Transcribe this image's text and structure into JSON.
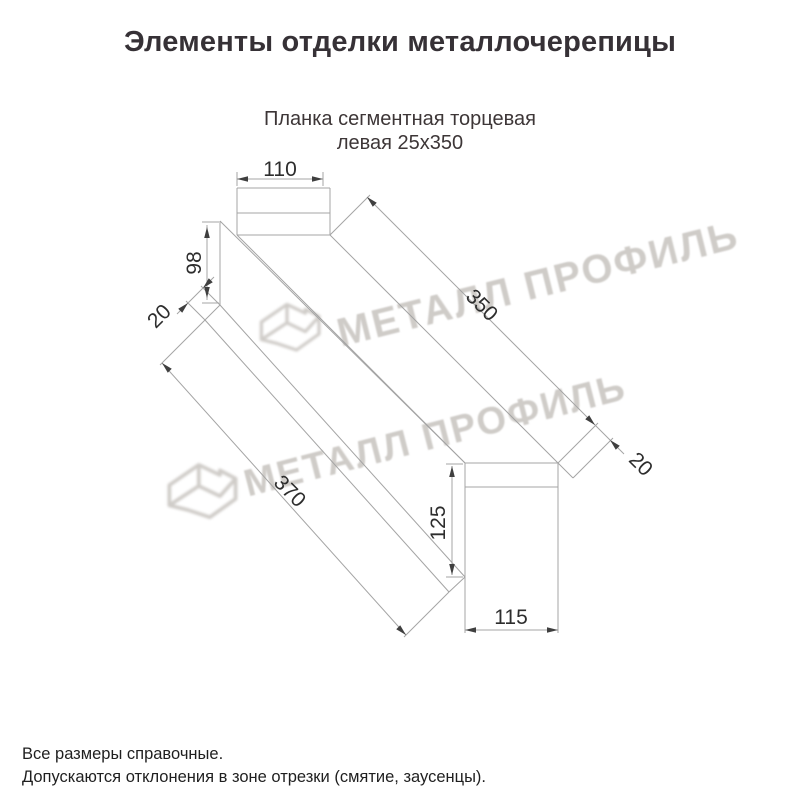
{
  "title": "Элементы отделки металлочерепицы",
  "subtitle_line1": "Планка сегментная торцевая",
  "subtitle_line2": "левая 25х350",
  "watermark": {
    "text": "МЕТАЛЛ ПРОФИЛЬ"
  },
  "notes": [
    "Все размеры справочные.",
    "Допускаются отклонения в зоне отрезки (смятие, заусенцы)."
  ],
  "colors": {
    "title": "#363136",
    "subtitle": "#3d3637",
    "line": "#a4a4a4",
    "arrow": "#3f3f3f",
    "dim_text": "#2d2d2d",
    "note_text": "#1f1f1f",
    "watermark": "#a8a29b"
  },
  "drawing": {
    "dimensions_mm": [
      110,
      98,
      20,
      350,
      20,
      370,
      125,
      115
    ],
    "lines": [
      [
        237,
        188,
        330,
        188
      ],
      [
        237,
        188,
        237,
        235
      ],
      [
        330,
        188,
        330,
        235
      ],
      [
        237,
        213,
        330,
        213
      ],
      [
        237,
        235,
        330,
        235
      ],
      [
        220,
        221,
        220,
        305
      ],
      [
        220,
        221,
        465,
        463
      ],
      [
        237,
        235,
        465,
        463
      ],
      [
        330,
        235,
        558,
        463
      ],
      [
        220,
        305,
        465,
        577
      ],
      [
        205,
        320,
        449,
        592
      ],
      [
        220,
        305,
        205,
        320
      ],
      [
        449,
        592,
        465,
        577
      ],
      [
        558,
        463,
        573,
        478
      ],
      [
        465,
        463,
        558,
        463
      ],
      [
        465,
        487,
        558,
        487
      ],
      [
        465,
        463,
        465,
        633
      ],
      [
        558,
        463,
        558,
        633
      ],
      [
        237,
        186,
        237,
        172
      ],
      [
        323,
        186,
        323,
        172
      ],
      [
        237,
        179,
        323,
        179
      ],
      [
        202,
        222,
        219,
        222
      ],
      [
        202,
        303,
        219,
        303
      ],
      [
        207,
        225,
        207,
        300
      ],
      [
        220,
        305,
        201,
        286
      ],
      [
        205,
        320,
        186,
        301
      ],
      [
        214,
        277,
        177,
        314
      ],
      [
        330,
        235,
        370,
        195
      ],
      [
        558,
        463,
        598,
        423
      ],
      [
        573,
        478,
        613,
        438
      ],
      [
        367,
        197,
        595,
        425
      ],
      [
        595,
        425,
        624,
        454
      ],
      [
        205,
        320,
        160,
        365
      ],
      [
        449,
        592,
        404,
        637
      ],
      [
        162,
        363,
        406,
        635
      ],
      [
        446,
        464,
        463,
        464
      ],
      [
        446,
        577,
        463,
        577
      ],
      [
        452,
        466,
        452,
        575
      ],
      [
        465,
        630,
        558,
        630
      ]
    ],
    "arrows": [
      [
        237,
        179,
        180
      ],
      [
        323,
        179,
        0
      ],
      [
        207,
        227,
        270
      ],
      [
        207,
        298,
        90
      ],
      [
        203,
        288,
        135
      ],
      [
        188,
        303,
        315
      ],
      [
        367,
        197,
        225
      ],
      [
        595,
        425,
        45
      ],
      [
        610,
        440,
        225
      ],
      [
        162,
        363,
        225
      ],
      [
        406,
        635,
        45
      ],
      [
        452,
        466,
        270
      ],
      [
        452,
        575,
        90
      ],
      [
        465,
        630,
        180
      ],
      [
        558,
        630,
        0
      ]
    ],
    "labels": [
      {
        "t": "110",
        "x": 280,
        "y": 169,
        "r": 0
      },
      {
        "t": "98",
        "x": 194,
        "y": 263,
        "r": -90
      },
      {
        "t": "20",
        "x": 159,
        "y": 316,
        "r": -45
      },
      {
        "t": "350",
        "x": 482,
        "y": 305,
        "r": 45
      },
      {
        "t": "20",
        "x": 641,
        "y": 464,
        "r": 45
      },
      {
        "t": "370",
        "x": 290,
        "y": 491,
        "r": 45
      },
      {
        "t": "125",
        "x": 438,
        "y": 523,
        "r": -90
      },
      {
        "t": "115",
        "x": 511,
        "y": 617,
        "r": 0
      }
    ]
  }
}
